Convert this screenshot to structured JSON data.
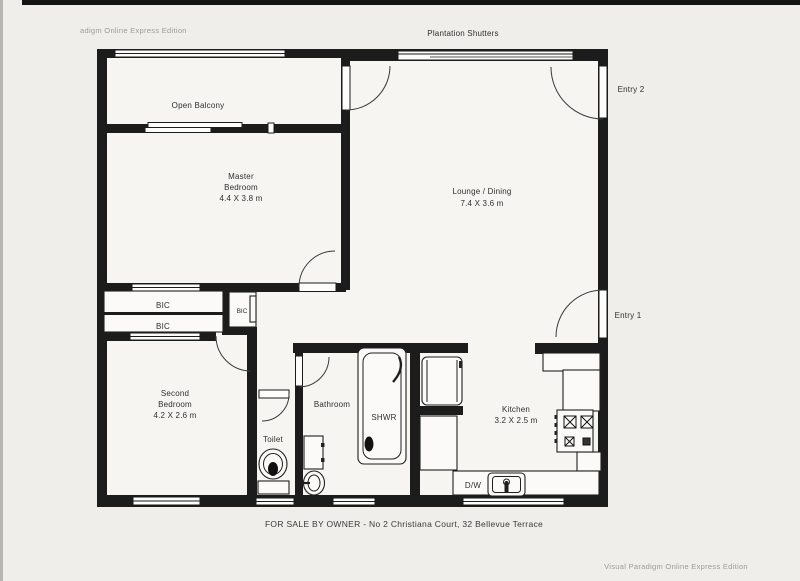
{
  "watermarks": {
    "top_left": "adigm Online Express Edition",
    "bottom_right": "Visual Paradigm Online Express Edition"
  },
  "footer": {
    "caption": "FOR SALE BY OWNER - No 2  Christiana Court, 32 Bellevue Terrace"
  },
  "rooms": {
    "balcony": {
      "label": "Open Balcony"
    },
    "master": {
      "line1": "Master",
      "line2": "Bedroom",
      "dims": "4.4 X 3.8 m"
    },
    "lounge": {
      "label": "Lounge / Dining",
      "dims": "7.4 X 3.6 m"
    },
    "second": {
      "line1": "Second",
      "line2": "Bedroom",
      "dims": "4.2 X 2.6 m"
    },
    "bathroom": {
      "label": "Bathroom"
    },
    "shower": {
      "label": "SHWR"
    },
    "toilet": {
      "label": "Toilet"
    },
    "kitchen": {
      "label": "Kitchen",
      "dims": "3.2 X 2.5 m"
    }
  },
  "features": {
    "entry1": "Entry 1",
    "entry2": "Entry 2",
    "plantation": "Plantation Shutters",
    "bic_top": "BIC",
    "bic_bottom": "BIC",
    "bic_small": "BIC",
    "dishwasher": "D/W"
  },
  "colors": {
    "wall": "#1c1c1c",
    "paper": "#efeeea",
    "text": "#2f2f2f",
    "watermark": "#9c9b97"
  }
}
